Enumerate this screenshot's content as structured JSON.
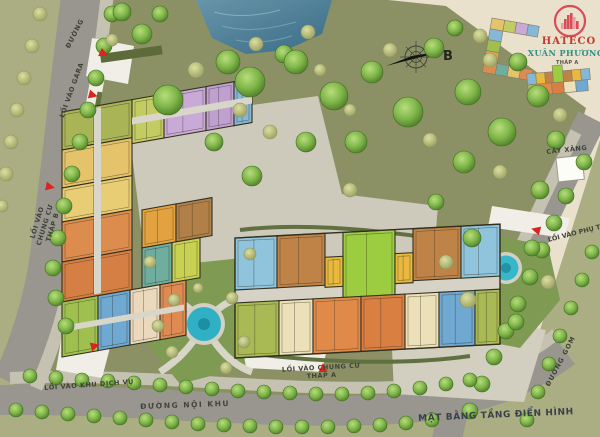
{
  "title": "MẶT BẰNG TẦNG ĐIỂN HÌNH",
  "brand": {
    "name_line1": "HATECO",
    "name_line2": "XUÂN PHƯƠNG",
    "logo_red": "#d94b57",
    "logo_teal": "#2e8f85"
  },
  "compass": {
    "north_label": "B"
  },
  "roads": {
    "top_street": "ĐƯỜNG",
    "internal_street": "ĐƯỜNG NỘI KHU",
    "collector_street": "ĐƯỜNG GOM"
  },
  "entrances": {
    "garage": "LỐI VÀO GARA",
    "tower_b": "LỐI VÀO CHUNG CƯ THÁP B",
    "services": "LỐI VÀO KHU DỊCH VỤ",
    "tower_a": "LỐI VÀO CHUNG CƯ THÁP A",
    "auxiliary": "LỐI VÀO PHỤ TRỢ"
  },
  "landmarks": {
    "gas_station": "CÂY XĂNG",
    "keyplan_tower_a_label": "THÁP A"
  },
  "map_colors": {
    "paper": "#e9e1cb",
    "park": "#8b9164",
    "verge": "#aaae82",
    "road": "#98968e",
    "sidewalk": "#c6c2b2",
    "plaza": "#cdc9bb",
    "lawn": "#7f9a52",
    "water": "#4a7d96",
    "pool": "#38b6ca",
    "arrow_red": "#d8251d",
    "unit_palette": [
      "#a9b457",
      "#e5c36a",
      "#dc8d4d",
      "#e7d4a5",
      "#c9a9d6",
      "#85b7d7",
      "#9fc04f",
      "#6fa8d0",
      "#ecd9bd",
      "#6fae9e",
      "#c9d152",
      "#e2a23f",
      "#b08048",
      "#8fc4dc",
      "#bf8348",
      "#9ccc3f",
      "#e8b93e",
      "#ece0b8",
      "#e08a4a",
      "#a9b954"
    ]
  }
}
